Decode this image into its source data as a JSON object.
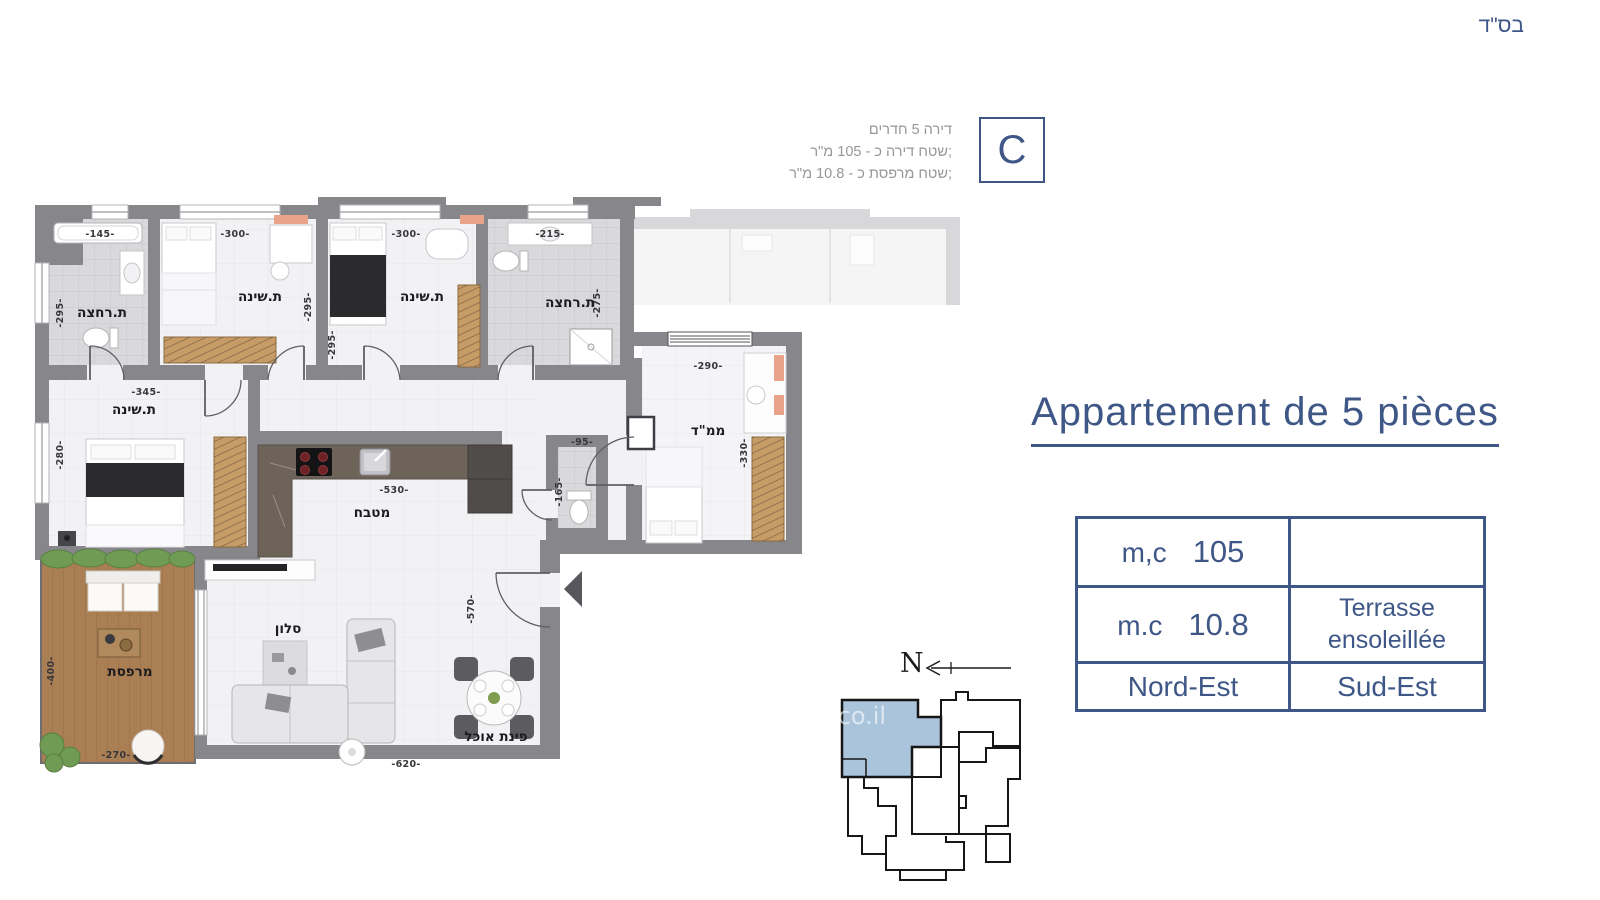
{
  "header": {
    "bsd": "בס\"ד"
  },
  "unit_badge": {
    "letter": "C"
  },
  "unit_info": {
    "line1": "דירה 5 חדרים",
    "line2": "שטח דירה כ - 105 מ\"ר;",
    "line3": "שטח מרפסת כ - 10.8 מ\"ר;"
  },
  "title": {
    "text": "Appartement de 5 pièces"
  },
  "info_table": {
    "row1": {
      "label": "m,c",
      "value": "105",
      "right": ""
    },
    "row2": {
      "label": "m.c",
      "value": "10.8",
      "right_line1": "Terrasse",
      "right_line2": "ensoleillée"
    },
    "row3": {
      "left": "Nord-Est",
      "right": "Sud-Est"
    }
  },
  "compass": {
    "letter": "N"
  },
  "watermark": {
    "text": ".co.il"
  },
  "floor_plan": {
    "rooms": {
      "bath1": "ת.רחצה",
      "bed1": "ת.שינה",
      "bed2": "ת.שינה",
      "bath2": "ת.רחצה",
      "bed3": "ת.שינה",
      "mamad": "ממ\"ד",
      "kitchen": "מטבח",
      "living": "סלון",
      "dining": "פינת אוכל",
      "balcony": "מרפסת"
    },
    "dims": {
      "bath1_w": "-145-",
      "bed1_w": "-300-",
      "bed2_w": "-300-",
      "bath2_w": "-215-",
      "bath1_h": "-295-",
      "bed1_h": "-295-",
      "bed2_h": "-295-",
      "bath2_h": "-275-",
      "bed3_w": "-345-",
      "bed3_h": "-280-",
      "mamad_w": "-290-",
      "mamad_h": "-330-",
      "kitchen_w": "-530-",
      "wc_w": "-95-",
      "wc_h": "-165-",
      "entry_h": "-570-",
      "living_w": "-620-",
      "balcony_h": "-400-",
      "balcony_w": "-270-"
    },
    "colors": {
      "wall": "#87878b",
      "floor": "#f2f2f4",
      "tile": "#d9d9db",
      "wood": "#c79b66",
      "deck": "#aa7f54",
      "counter": "#6e6359",
      "accent_navy": "#3e5787",
      "keyplan_highlight": "#aac4dc"
    }
  }
}
